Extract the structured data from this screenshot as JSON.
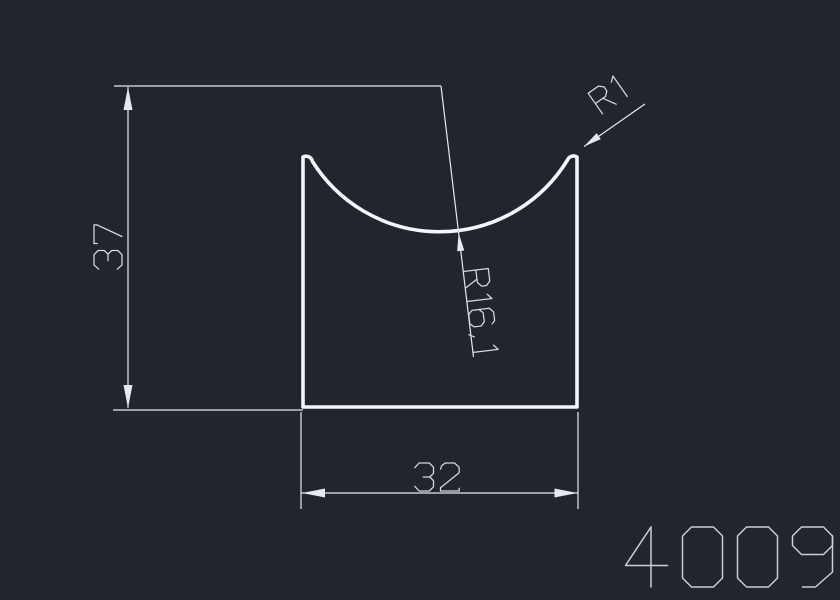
{
  "page": {
    "background": "#21262e"
  },
  "drawing": {
    "part_number": "4009",
    "dimensions": [
      {
        "name": "overall-height",
        "label": "37",
        "value": 37,
        "unit": "mm",
        "kind": "linear-vertical"
      },
      {
        "name": "overall-width",
        "label": "32",
        "value": 32,
        "unit": "mm",
        "kind": "linear-horizontal"
      },
      {
        "name": "corner-fillet-radius",
        "label": "R1",
        "value": 1,
        "unit": "mm",
        "kind": "radius"
      },
      {
        "name": "groove-radius",
        "label": "R16,1",
        "value": 16.1,
        "unit": "mm",
        "kind": "radius"
      }
    ],
    "colors": {
      "profile_stroke": "#f3f5f7",
      "dimension_stroke": "#e7e9ec",
      "dimension_text": "#d7dade",
      "part_number_text": "#c9cdd4"
    }
  }
}
